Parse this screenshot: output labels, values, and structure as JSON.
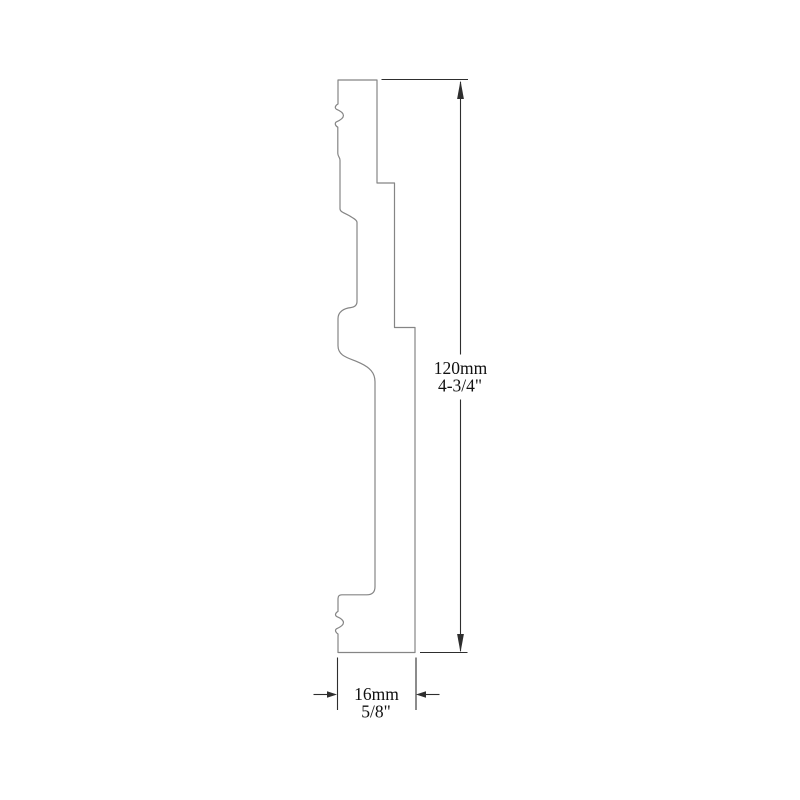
{
  "page": {
    "background": "#ffffff",
    "description": "Technical drawing: skirting board moulding profile cross-section with height and width dimensions"
  },
  "drawing": {
    "profile_stroke": "#858585",
    "dimension_color": "#2e2e2e",
    "text_color": "#111111",
    "profile_path": "M 338 80 H 377 V 183 H 394.5 V 327.5 H 415 V 652.5 H 338 V 634 C 335.3 632.2 334.8 630 336.5 628.8 C 345.8 624.8 345.8 620.2 336.5 616.4 C 334.8 615.2 335.3 613 338 611.4 V 598.6 Q 338 594.8 341.8 594.8 H 366.8 Q 375 594.8 375 586.6 V 381.8 C 375 372.5 369.5 367.5 360.5 363.2 C 349.5 358 338 356.8 338 345.8 V 318.6 C 338 311.8 344.2 308.2 350.6 307.6 C 354.8 307.2 357 305.2 357 301.4 V 222.4 C 357 219.8 353.4 218.4 349.4 215.8 C 344.6 212.8 340 212.2 340 208.6 V 160.2 C 340 157.2 337.8 156.6 337.8 153.2 V 127.2 C 335 125.6 334.6 123.2 336.3 121.9 C 345.8 117.9 345.8 113.1 336.3 109.2 C 334.6 107.9 335 105.6 338 104 Z"
  },
  "dimensions": {
    "height": {
      "metric": "120mm",
      "imperial": "4-3/4\""
    },
    "width": {
      "metric": "16mm",
      "imperial": "5/8\""
    }
  }
}
